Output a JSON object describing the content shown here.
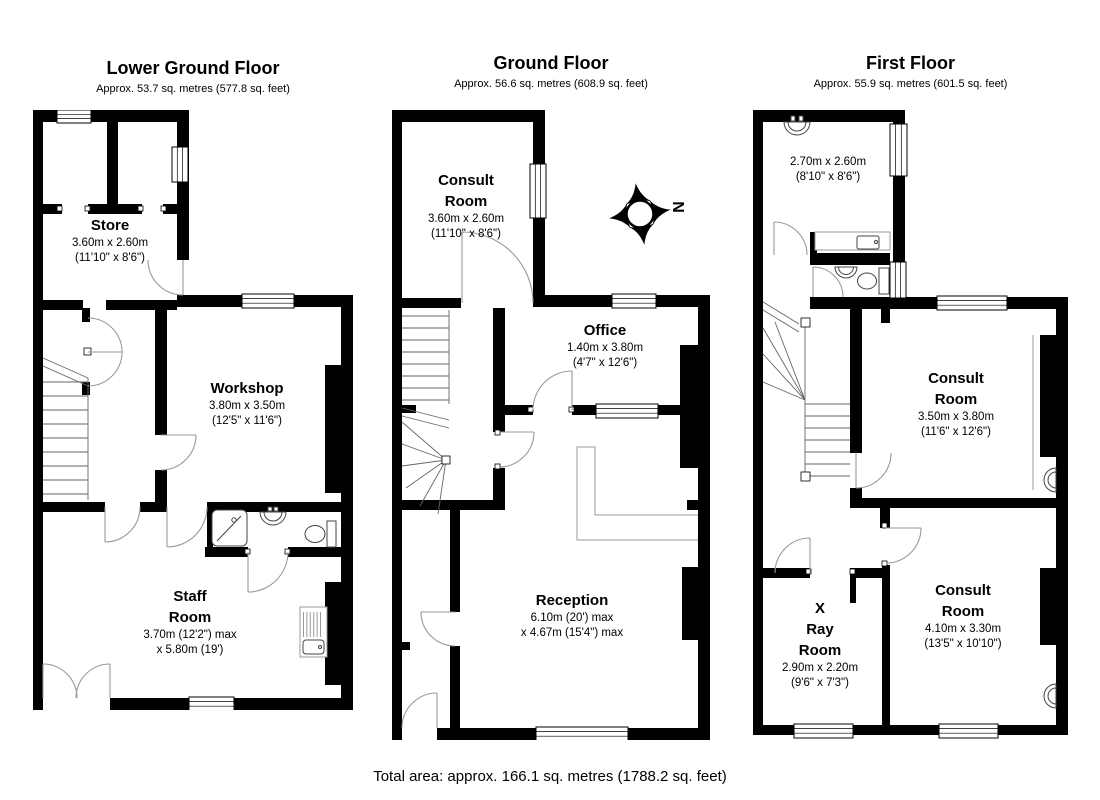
{
  "floors": {
    "lower_ground": {
      "title": "Lower Ground Floor",
      "subtitle": "Approx. 53.7 sq. metres (577.8 sq. feet)"
    },
    "ground": {
      "title": "Ground Floor",
      "subtitle": "Approx. 56.6 sq. metres (608.9 sq. feet)"
    },
    "first": {
      "title": "First Floor",
      "subtitle": "Approx. 55.9 sq. metres (601.5 sq. feet)"
    }
  },
  "rooms": {
    "lgf_store": {
      "name": "Store",
      "dim1": "3.60m x 2.60m",
      "dim2": "(11'10\" x 8'6\")"
    },
    "lgf_workshop": {
      "name": "Workshop",
      "dim1": "3.80m x 3.50m",
      "dim2": "(12'5\" x 11'6\")"
    },
    "lgf_staff": {
      "name1": "Staff",
      "name2": "Room",
      "dim1": "3.70m (12'2\") max",
      "dim2": "x 5.80m (19')"
    },
    "gf_consult": {
      "name1": "Consult",
      "name2": "Room",
      "dim1": "3.60m x 2.60m",
      "dim2": "(11'10\" x 8'6\")"
    },
    "gf_office": {
      "name": "Office",
      "dim1": "1.40m x 3.80m",
      "dim2": "(4'7\" x 12'6\")"
    },
    "gf_reception": {
      "name": "Reception",
      "dim1": "6.10m (20') max",
      "dim2": "x 4.67m (15'4\") max"
    },
    "ff_top_room": {
      "dim1": "2.70m x 2.60m",
      "dim2": "(8'10\" x 8'6\")"
    },
    "ff_consult_mid": {
      "name1": "Consult",
      "name2": "Room",
      "dim1": "3.50m x 3.80m",
      "dim2": "(11'6\" x 12'6\")"
    },
    "ff_xray": {
      "name1": "X",
      "name2": "Ray",
      "name3": "Room",
      "dim1": "2.90m x 2.20m",
      "dim2": "(9'6\" x 7'3\")"
    },
    "ff_consult_bottom": {
      "name1": "Consult",
      "name2": "Room",
      "dim1": "4.10m x 3.30m",
      "dim2": "(13'5\" x 10'10\")"
    }
  },
  "compass": {
    "label": "N"
  },
  "footer": {
    "total_area": "Total area: approx. 166.1 sq. metres (1788.2 sq. feet)"
  }
}
